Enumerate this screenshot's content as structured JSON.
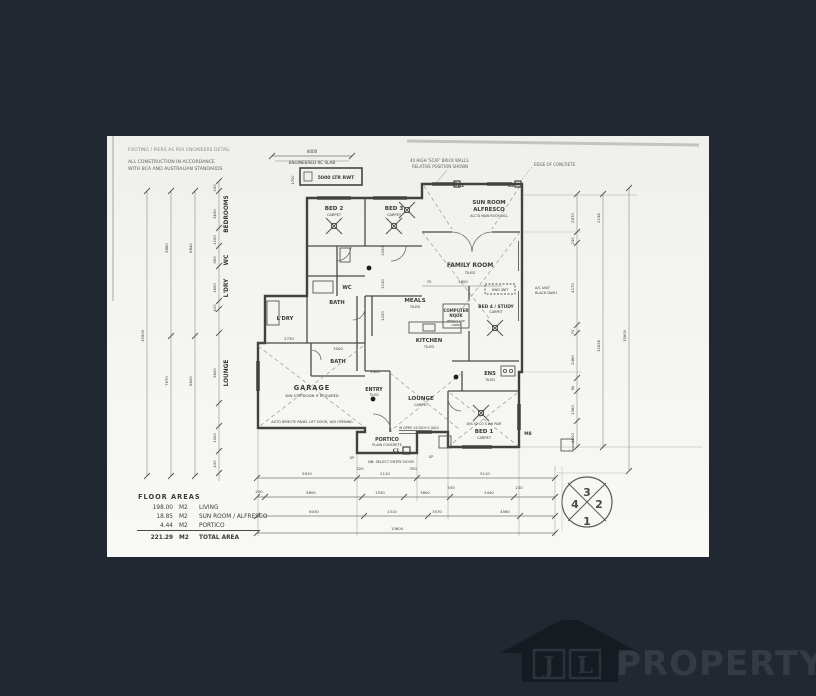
{
  "canvas": {
    "bg": "#222831",
    "paper": "#f4f4f0"
  },
  "plan": {
    "notes": [
      "FOOTING / PIERS AS PER ENGINEERS DETAIL",
      "ALL CONSTRUCTION IN ACCORDANCE",
      "WITH BCA AND AUSTRALIAN STANDARDS"
    ],
    "top": {
      "dim": "4000",
      "slab": "ENGINEERED RC SLAB",
      "rwt": "5000 LTR RWT",
      "rwt_side": "1700",
      "brick1": "40 HIGH 'SCAF' BRICK WALLS",
      "brick2": "RELATIVE POSITION SHOWN",
      "edge": "EDGE OF CONCRETE",
      "c2": "C2",
      "c3": "C3"
    },
    "rooms": {
      "bed2": {
        "n": "BED 2",
        "s": "CARPET"
      },
      "bed3": {
        "n": "BED 3",
        "s": "CARPET"
      },
      "sunroom": {
        "n": "SUN ROOM",
        "n2": "ALFRESCO",
        "s": "ACC'D MAIN ROOF INCL"
      },
      "family": {
        "n": "FAMILY  ROOM",
        "s": "TILED"
      },
      "meals": {
        "n": "MEALS",
        "s": "TILED"
      },
      "computer": {
        "n": "COMPUTER",
        "n2": "NOOK",
        "s1": "BENCH TOP",
        "s2": "LINEN"
      },
      "bed4": {
        "n": "BED 4 / STUDY",
        "s": "CARPET"
      },
      "wc": {
        "n": "WC"
      },
      "bath1": {
        "n": "BATH"
      },
      "ldry": {
        "n": "L'DRY"
      },
      "kitchen": {
        "n": "KITCHEN",
        "s": "TILED"
      },
      "bath2": {
        "n": "BATH"
      },
      "garage": {
        "n": "GARAGE",
        "s": "B/W STEPDOWN IF REQUIRED",
        "note": "AUTO REMOTE PANEL LIFT DOOR, W/S OPENING"
      },
      "entry": {
        "n": "ENTRY",
        "s": "TILED"
      },
      "lounge": {
        "n": "LOUNGE",
        "s": "CARPET"
      },
      "ens": {
        "n": "ENS",
        "s": "TILED"
      },
      "bed1": {
        "n": "BED 1",
        "s": "CARPET",
        "note": "W/S 92 CO S WH PAIR"
      },
      "portico": {
        "n": "PORTICO",
        "s": "PLAIN CONCRETE",
        "c1": "C1",
        "nb": "NB: SELECT ENTRY DOOR"
      },
      "hwd": "HWD UNIT",
      "ac1": "A/C UNIT",
      "ac2": "BLACK DASH",
      "m8": "M8",
      "gp": "GP",
      "win_codes": "W DPRO      19 DICH      S GALV"
    },
    "dims": {
      "left": [
        "15900",
        "5860",
        "7670",
        "6840",
        "6600",
        "230",
        "3630",
        "1100",
        "900",
        "1600",
        "410",
        "3600",
        "1000",
        "430"
      ],
      "left_tags": [
        "BEDROOMS",
        "WC",
        "L'DRY",
        "LOUNGE"
      ],
      "right": [
        "2970",
        "230",
        "4170",
        "70",
        "2460",
        "90",
        "1060",
        "1600",
        "2136",
        "12626",
        "15800"
      ],
      "b1": [
        "5910",
        "320",
        "2110",
        "350",
        "5110"
      ],
      "b2": [
        "230",
        "5800",
        "1530",
        "3800",
        "530",
        "3440",
        "230"
      ],
      "b3": [
        "6030",
        "1310",
        "3570",
        "4560"
      ],
      "b4": "13600",
      "inner": [
        "70",
        "2600",
        "2730",
        "3000",
        "1400",
        "1200",
        "1130",
        "1200"
      ]
    },
    "areas": {
      "title": "FLOOR  AREAS",
      "rows": [
        {
          "v": "198.00",
          "u": "M2",
          "d": "LIVING"
        },
        {
          "v": "18.85",
          "u": "M2",
          "d": "SUN ROOM / ALFRESCO"
        },
        {
          "v": "4.44",
          "u": "M2",
          "d": "PORTICO"
        }
      ],
      "total": {
        "v": "221.29",
        "u": "M2",
        "d": "TOTAL AREA"
      }
    },
    "quadrant": {
      "top": "3",
      "right": "2",
      "bottom": "1",
      "left": "4"
    }
  },
  "watermark": {
    "j": "J",
    "l": "L",
    "name": "PROPERTY"
  }
}
